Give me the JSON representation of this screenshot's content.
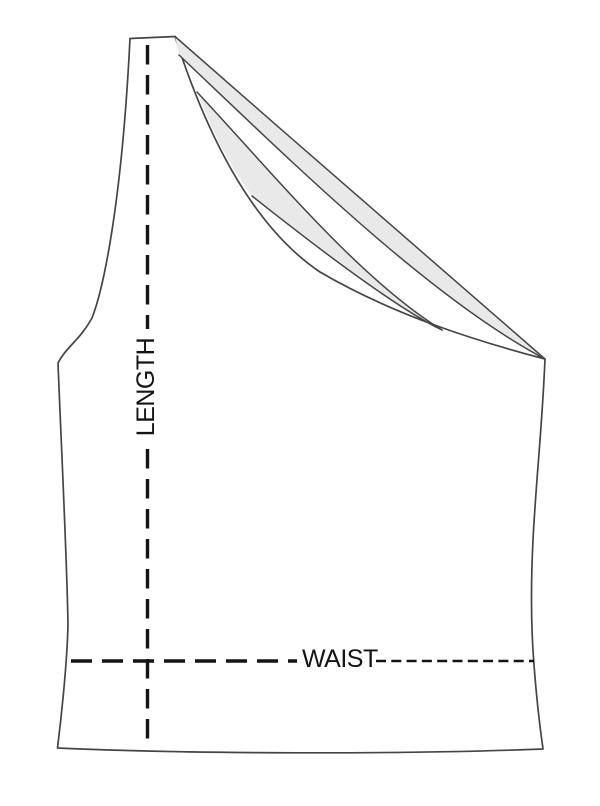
{
  "diagram": {
    "type": "garment-size-guide",
    "garment": "one-shoulder-top-flat-sketch",
    "labels": {
      "length": "LENGTH",
      "waist": "WAIST"
    },
    "colors": {
      "background": "#ffffff",
      "garment_fill": "#e9e9e9",
      "outline": "#454545",
      "measurement": "#141414"
    }
  }
}
